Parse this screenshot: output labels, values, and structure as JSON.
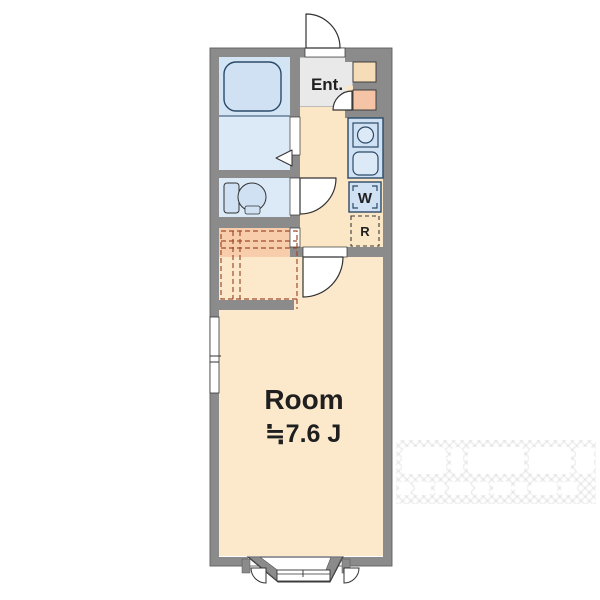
{
  "floorplan": {
    "labels": {
      "entrance": "Ent.",
      "washer": "W",
      "refrigerator": "R"
    },
    "room": {
      "name": "Room",
      "size": "≒7.6 J"
    }
  },
  "colors": {
    "wall_gray": "#8b8b8b",
    "floor_cream": "#fbe6c6",
    "room_cream": "#fce9cc",
    "wet_area_blue": "#dceaf8",
    "fixture_blue": "#cfe1f3",
    "fixture_stroke": "#2b4a68",
    "entrance_gray": "#e9e9e9",
    "closet_fill": "#f7cdab",
    "closet_dash": "#a14b2c",
    "storage_beige": "#f7dcb8",
    "storage_pink": "#f5c3a6"
  }
}
